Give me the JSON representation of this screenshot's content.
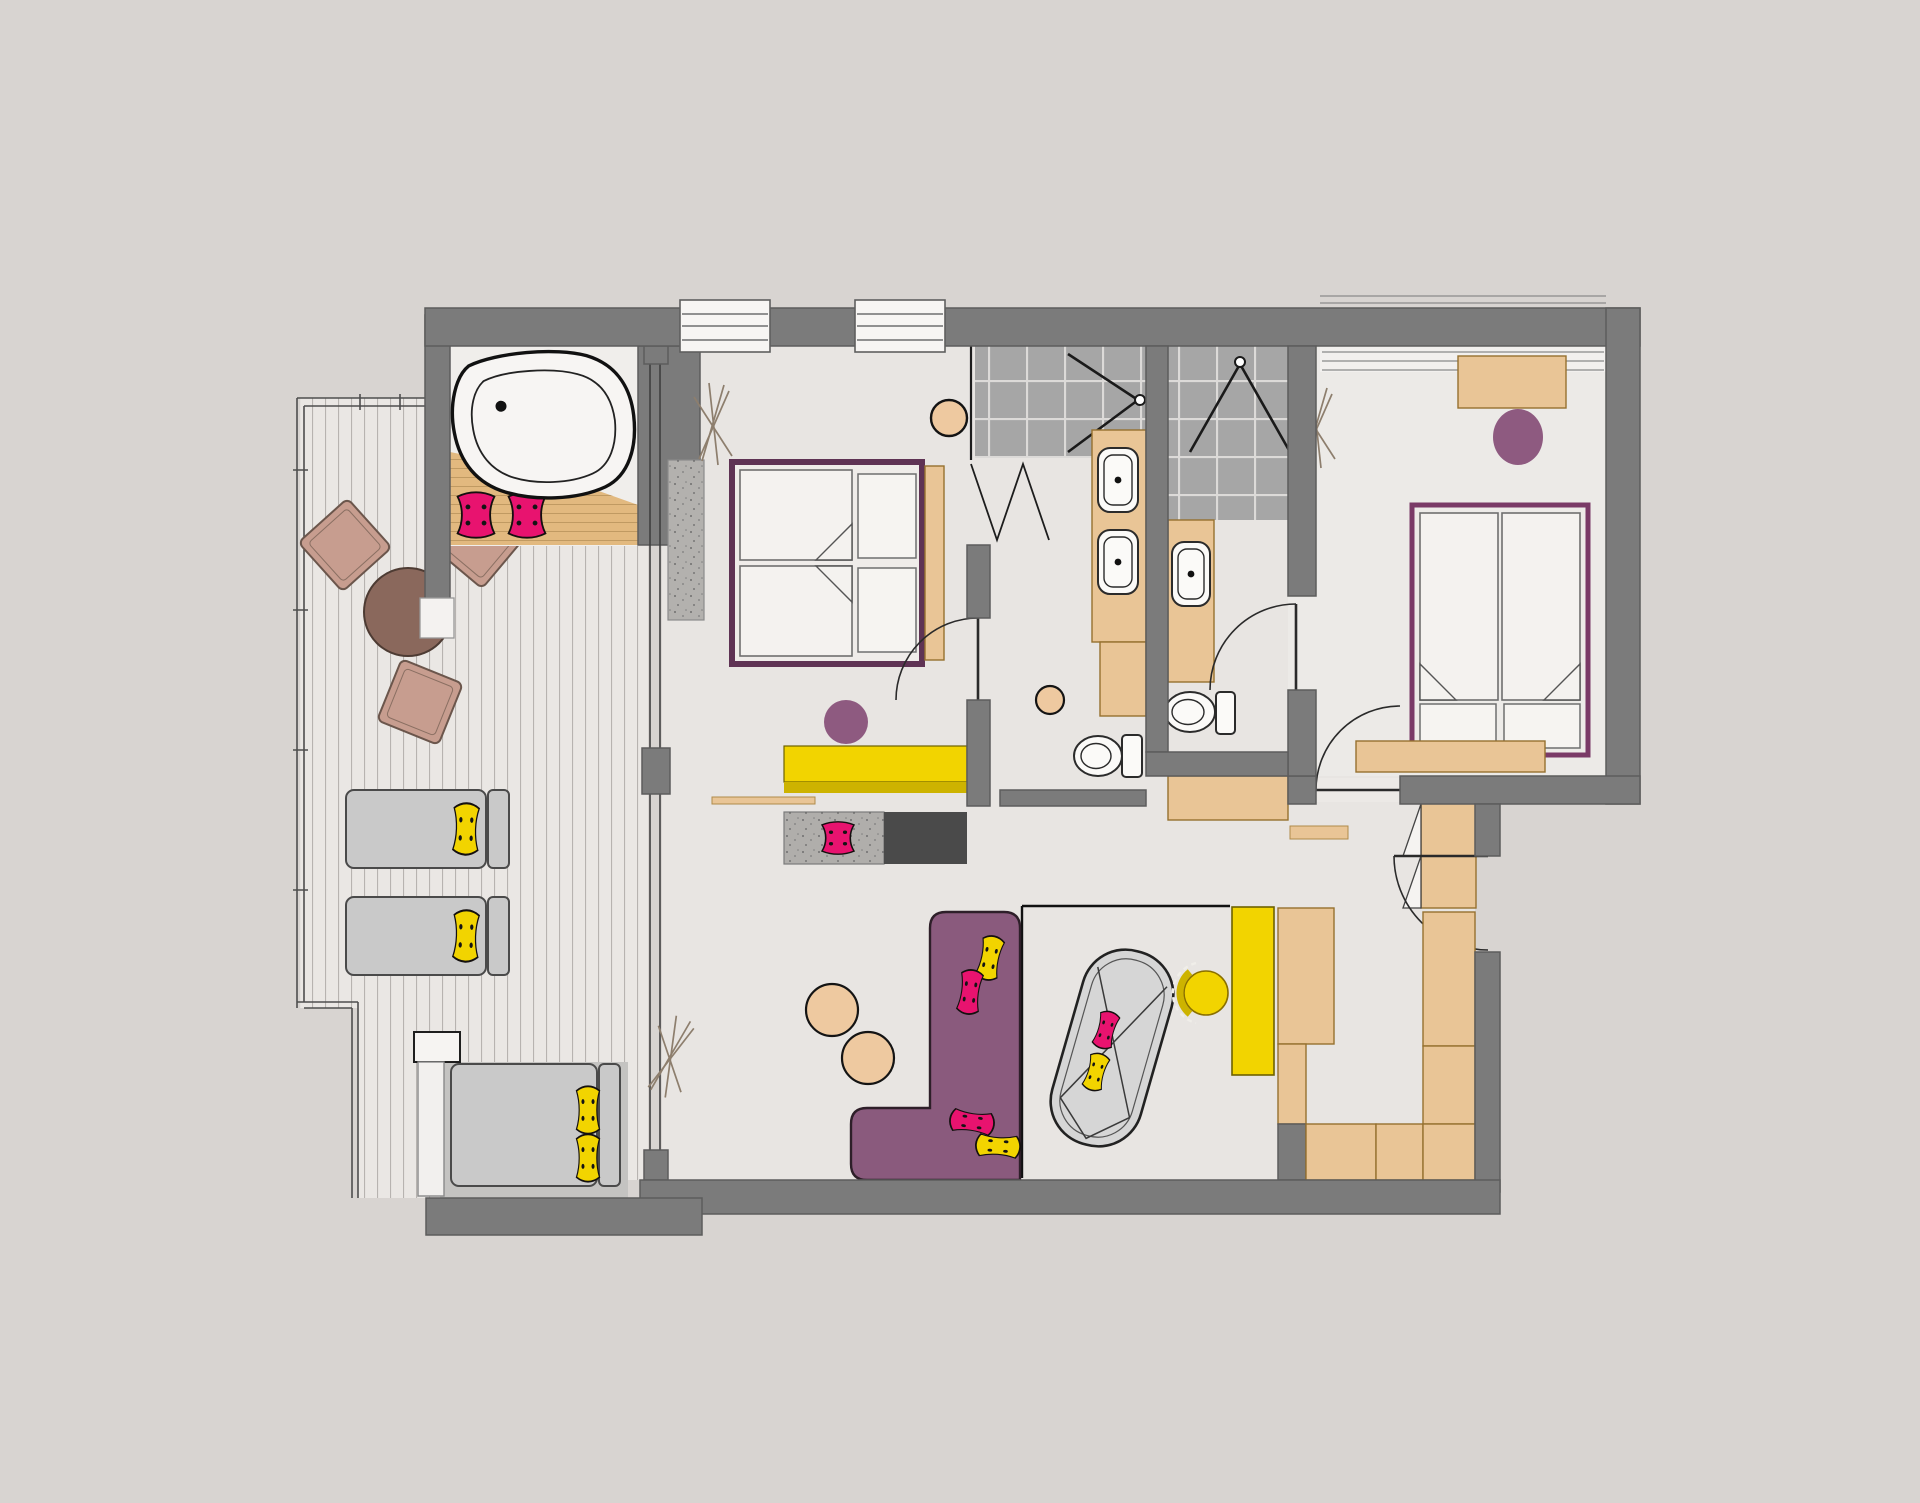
{
  "title": "hotel-suite-floor-plan",
  "palette": {
    "bg": "#d8d4d1",
    "wall": "#7b7b7b",
    "floor": "#e8e5e2",
    "floor2": "#eceae7",
    "tile": "#a6a6a6",
    "deck": "#eae7e4",
    "terrace": "#c4c3c1",
    "wood": "#e9c596",
    "woodDeck": "#e2b97f",
    "yellow": "#f2d400",
    "yellowDark": "#cdb300",
    "magenta": "#e8136f",
    "sofaPurple": "#8a5a7d",
    "stoolPurple": "#8e5a80",
    "tanStool": "#eec9a0",
    "loungerGray": "#c9c9c9",
    "chaiseGray": "#d6d6d6",
    "tableBrown": "#8a685c",
    "chairTan": "#c79d8f",
    "rugGray": "#b3b1ae",
    "darkUnit": "#4a4a4a",
    "white": "#f7f5f3"
  },
  "rooms": {
    "balcony": "balcony-terrace",
    "bathNiche": "bathtub-niche",
    "masterBedroom": "master-bedroom",
    "bathroom1": "ensuite-bathroom-1",
    "bathroom2": "ensuite-bathroom-2",
    "bedroom2": "second-bedroom",
    "living": "living-study-area",
    "hallway": "entry-hallway"
  },
  "inventory": {
    "bathtub": 1,
    "showers": 2,
    "washbasins": 3,
    "toilets": 2,
    "double_beds": 2,
    "sun_loungers": 3,
    "sofas": 1,
    "chaise_longue": 1,
    "desks": 3,
    "stools": 5,
    "terrace_chairs": 3,
    "terrace_tables": 1,
    "wardrobe_units": 8,
    "windows": 3,
    "doors": 6,
    "cushions": 12
  }
}
